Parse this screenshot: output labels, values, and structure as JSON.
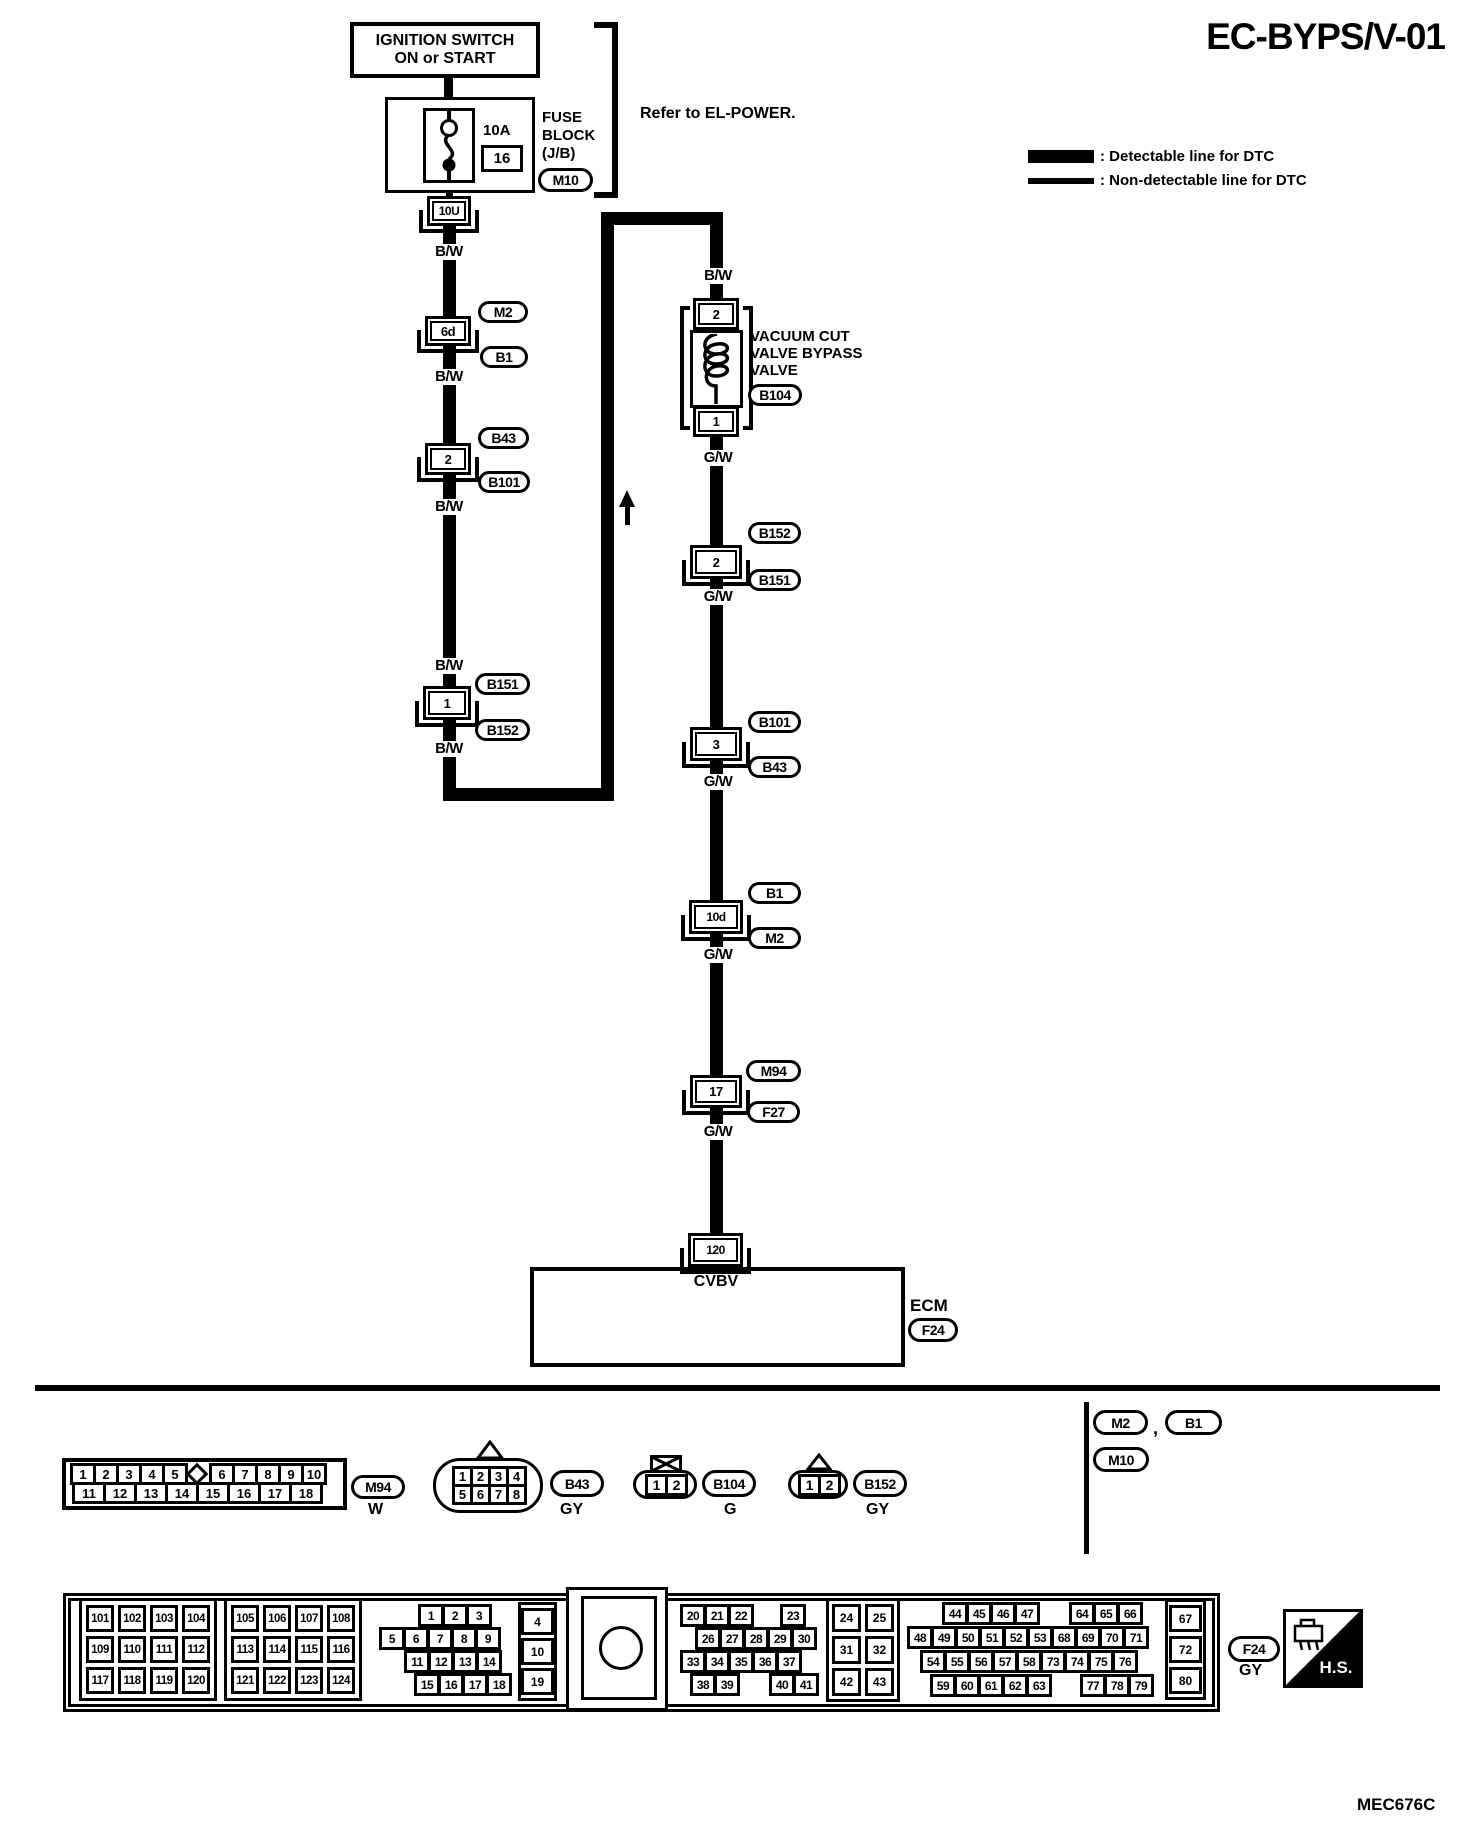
{
  "title": "EC-BYPS/V-01",
  "legend": {
    "detectable": ": Detectable line for DTC",
    "non_detectable": ": Non-detectable line for DTC"
  },
  "power": {
    "ignition_line1": "IGNITION SWITCH",
    "ignition_line2": "ON or START",
    "refer": "Refer to EL-POWER.",
    "fuse_rating": "10A",
    "fuse_number": "16",
    "fuse_block_line1": "FUSE",
    "fuse_block_line2": "BLOCK",
    "fuse_block_line3": "(J/B)",
    "fuse_block_ref": "M10",
    "fuse_out_pin": "10U"
  },
  "wires": {
    "bw": "B/W",
    "gw": "G/W"
  },
  "left_chain": {
    "connectors": [
      {
        "pin": "6d",
        "ref_top": "M2",
        "ref_bottom": "B1"
      },
      {
        "pin": "2",
        "ref_top": "B43",
        "ref_bottom": "B101"
      },
      {
        "pin": "1",
        "ref_top": "B151",
        "ref_bottom": "B152"
      }
    ]
  },
  "valve": {
    "pin_top": "2",
    "pin_bottom": "1",
    "name_line1": "VACUUM CUT",
    "name_line2": "VALVE BYPASS",
    "name_line3": "VALVE",
    "ref": "B104"
  },
  "right_chain": {
    "connectors": [
      {
        "pin": "2",
        "ref_top": "B152",
        "ref_bottom": "B151"
      },
      {
        "pin": "3",
        "ref_top": "B101",
        "ref_bottom": "B43"
      },
      {
        "pin": "10d",
        "ref_top": "B1",
        "ref_bottom": "M2"
      },
      {
        "pin": "17",
        "ref_top": "M94",
        "ref_bottom": "F27"
      }
    ]
  },
  "ecm": {
    "pin": "120",
    "signal": "CVBV",
    "label": "ECM",
    "ref": "F24"
  },
  "connector_views": {
    "m94": {
      "row1a": [
        "1",
        "2",
        "3",
        "4",
        "5"
      ],
      "row1b": [
        "6",
        "7",
        "8",
        "9",
        "10"
      ],
      "row2": [
        "11",
        "12",
        "13",
        "14",
        "15",
        "16",
        "17",
        "18"
      ],
      "ref": "M94",
      "color": "W"
    },
    "b43": {
      "row1": [
        "1",
        "2",
        "3",
        "4"
      ],
      "row2": [
        "5",
        "6",
        "7",
        "8"
      ],
      "ref": "B43",
      "color": "GY"
    },
    "b104": {
      "pins": [
        "1",
        "2"
      ],
      "ref": "B104",
      "color": "G"
    },
    "b152": {
      "pins": [
        "1",
        "2"
      ],
      "ref": "B152",
      "color": "GY"
    },
    "note_refs": {
      "a": "M2",
      "comma": ",",
      "b": "B1",
      "c": "M10"
    }
  },
  "ecm_connector": {
    "block_a": [
      "101",
      "102",
      "103",
      "104",
      "109",
      "110",
      "111",
      "112",
      "117",
      "118",
      "119",
      "120"
    ],
    "block_b": [
      "105",
      "106",
      "107",
      "108",
      "113",
      "114",
      "115",
      "116",
      "121",
      "122",
      "123",
      "124"
    ],
    "block_c": {
      "r1": [
        "1",
        "2",
        "3"
      ],
      "r2": [
        "5",
        "6",
        "7",
        "8",
        "9"
      ],
      "r3": [
        "11",
        "12",
        "13",
        "14"
      ],
      "r4": [
        "15",
        "16",
        "17",
        "18"
      ]
    },
    "col_left": [
      "4",
      "10",
      "19"
    ],
    "block_d": {
      "r1a": [
        "20",
        "21",
        "22"
      ],
      "r1b": [
        "23"
      ],
      "r2": [
        "26",
        "27",
        "28",
        "29",
        "30"
      ],
      "r3": [
        "33",
        "34",
        "35",
        "36",
        "37"
      ],
      "r4a": [
        "38",
        "39"
      ],
      "r4b": [
        "40",
        "41"
      ]
    },
    "block_e": [
      "24",
      "25",
      "31",
      "32",
      "42",
      "43"
    ],
    "block_f": {
      "r1a": [
        "44",
        "45",
        "46",
        "47"
      ],
      "r1b": [
        "64",
        "65",
        "66"
      ],
      "r2": [
        "48",
        "49",
        "50",
        "51",
        "52",
        "53",
        "68",
        "69",
        "70",
        "71"
      ],
      "r3": [
        "54",
        "55",
        "56",
        "57",
        "58",
        "73",
        "74",
        "75",
        "76"
      ],
      "r4a": [
        "59",
        "60",
        "61",
        "62",
        "63"
      ],
      "r4b": [
        "77",
        "78",
        "79"
      ]
    },
    "col_right": [
      "67",
      "72",
      "80"
    ],
    "ref": "F24",
    "color": "GY",
    "hs": "H.S."
  },
  "footer_code": "MEC676C",
  "colors": {
    "ink": "#000000",
    "paper": "#ffffff"
  }
}
